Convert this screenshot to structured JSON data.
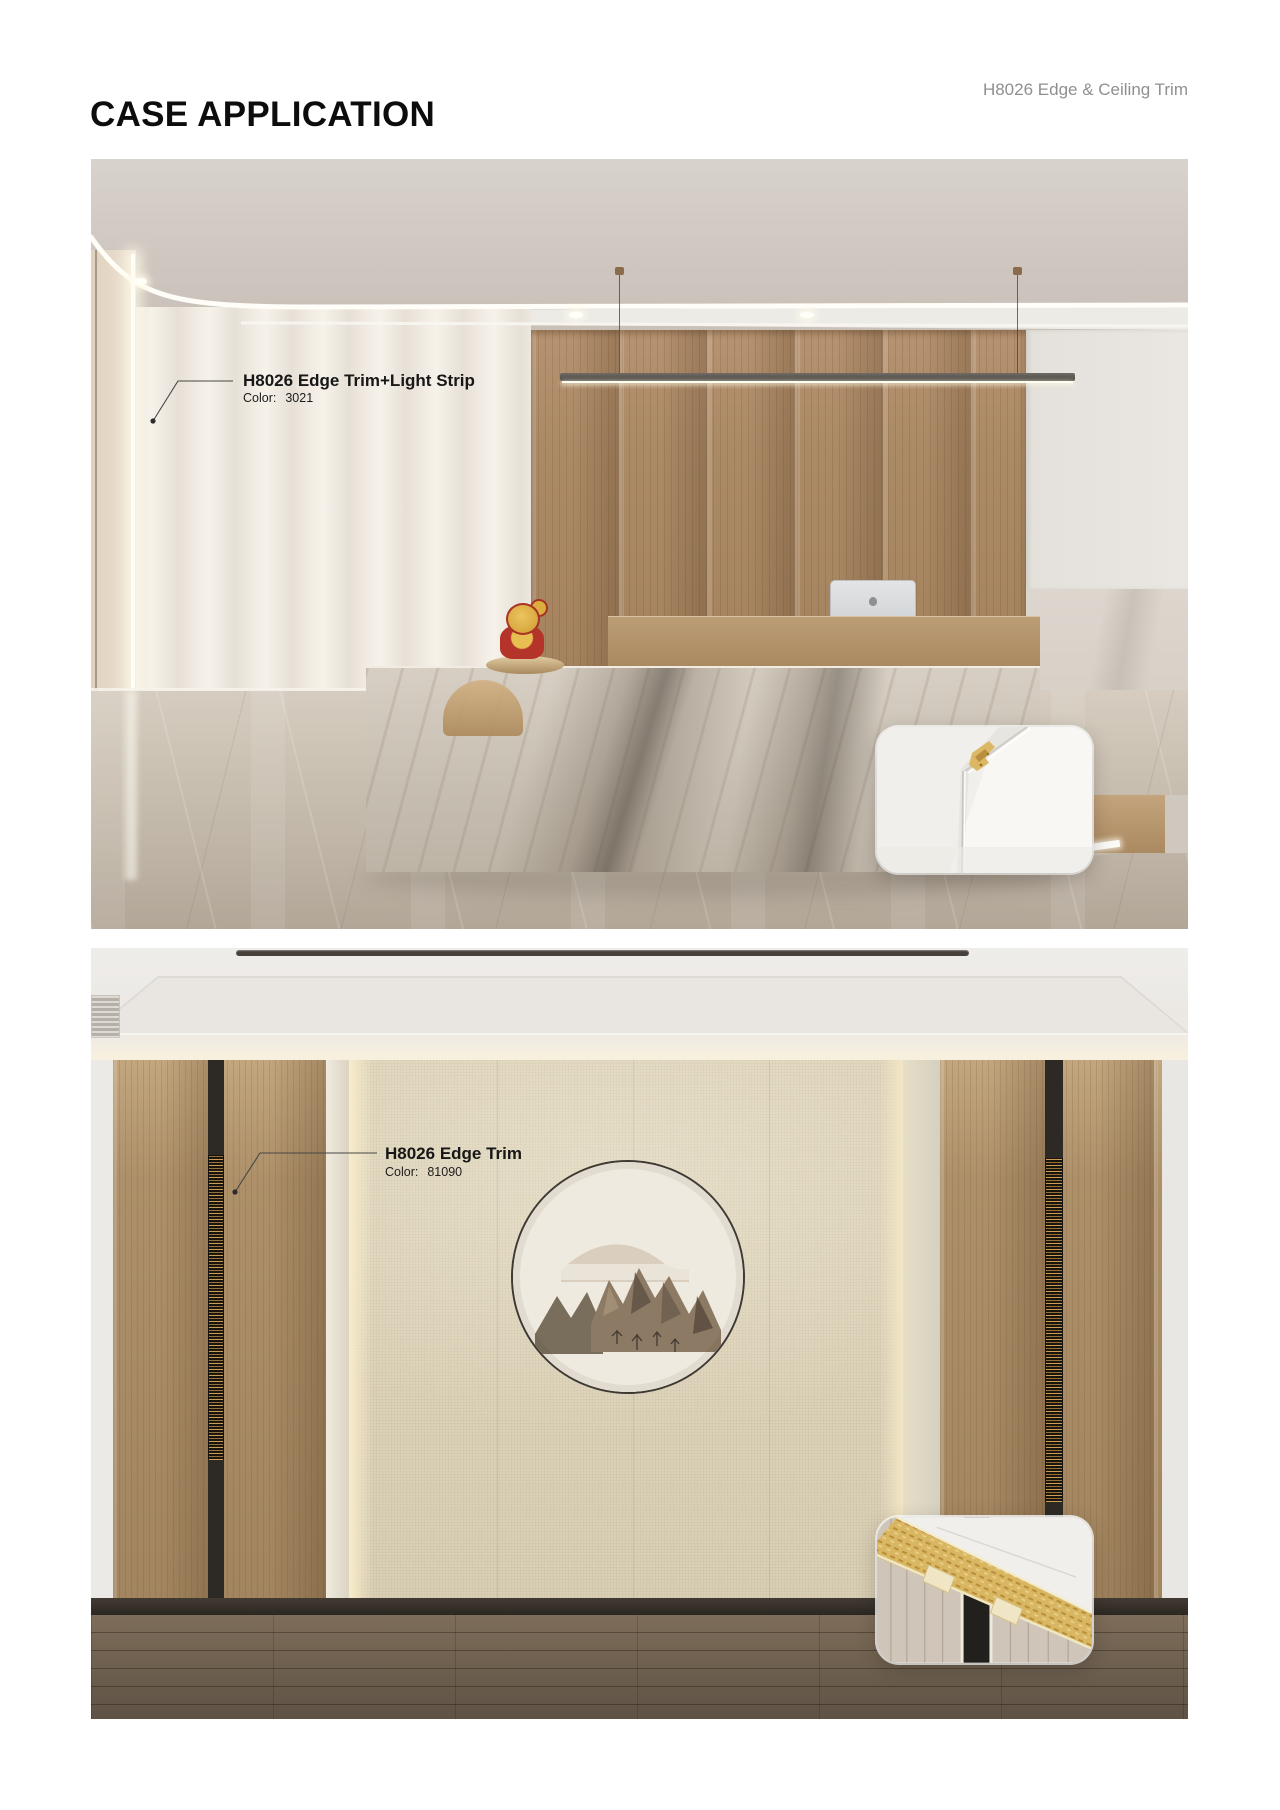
{
  "header": {
    "title": "CASE APPLICATION",
    "product": "H8026 Edge & Ceiling Trim"
  },
  "case1": {
    "annotation": {
      "label": "H8026 Edge Trim+Light Strip",
      "color_label": "Color:",
      "color_value": "3021"
    }
  },
  "case2": {
    "annotation": {
      "label": "H8026 Edge Trim",
      "color_label": "Color:",
      "color_value": "81090"
    }
  },
  "colors": {
    "page_background": "#ffffff",
    "title_text": "#0d0d0d",
    "product_text": "#8f8f8f",
    "annotation_text": "#1a1a1a",
    "wood_wall": "#ab8a66",
    "marble_desk": "#ccc4b7",
    "counter_bronze": "#ad8d66",
    "beige_panel": "#ddd3ba",
    "gold_trim": "#d9b767",
    "dark_inlay": "#2d2a26"
  }
}
